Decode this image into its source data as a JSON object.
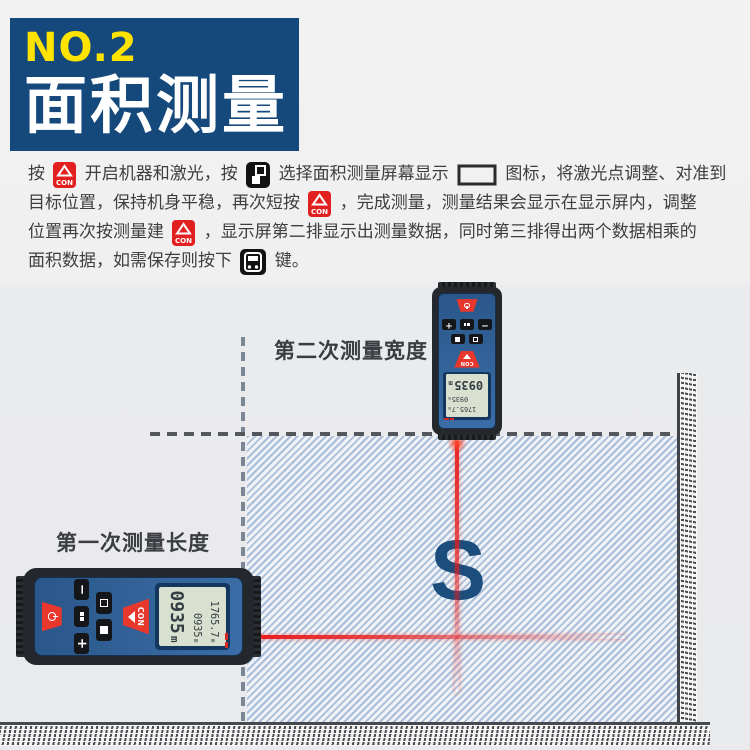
{
  "banner": {
    "number": "NO.2",
    "title": "面积测量"
  },
  "instructions": {
    "lines": [
      [
        {
          "t": "按 "
        },
        {
          "i": "con"
        },
        {
          "t": " 开启机器和激光，按 "
        },
        {
          "i": "unit"
        },
        {
          "t": " 选择面积测量屏幕显示 "
        },
        {
          "i": "area"
        },
        {
          "t": " 图标，将激光点调整、对准到"
        }
      ],
      [
        {
          "t": "目标位置，保持机身平稳，再次短按 "
        },
        {
          "i": "con"
        },
        {
          "t": " ，完成测量，测量结果会显示在显示屏内，调整"
        }
      ],
      [
        {
          "t": "位置再次按测量建 "
        },
        {
          "i": "con"
        },
        {
          "t": " ，显示屏第二排显示出测量数据，同时第三排得出两个数据相乘的"
        }
      ],
      [
        {
          "t": "面积数据，如需保存则按下 "
        },
        {
          "i": "save"
        },
        {
          "t": " 键。"
        }
      ]
    ]
  },
  "diagram": {
    "label_second": "第二次测量宽度",
    "label_first": "第一次测量长度",
    "area_symbol": "S",
    "device": {
      "con_label": "CON",
      "unit": "m",
      "screen_rows": [
        "1765.7",
        "0935",
        "0935"
      ]
    }
  },
  "colors": {
    "banner_bg": "#15497b",
    "banner_number": "#ffe300",
    "laser_red": "#e91c1c",
    "area_symbol_blue": "#1b4d7d",
    "hatch_stripe": "#a9bed8",
    "device_blue": "#3a6da6",
    "button_red": "#e8372c"
  }
}
